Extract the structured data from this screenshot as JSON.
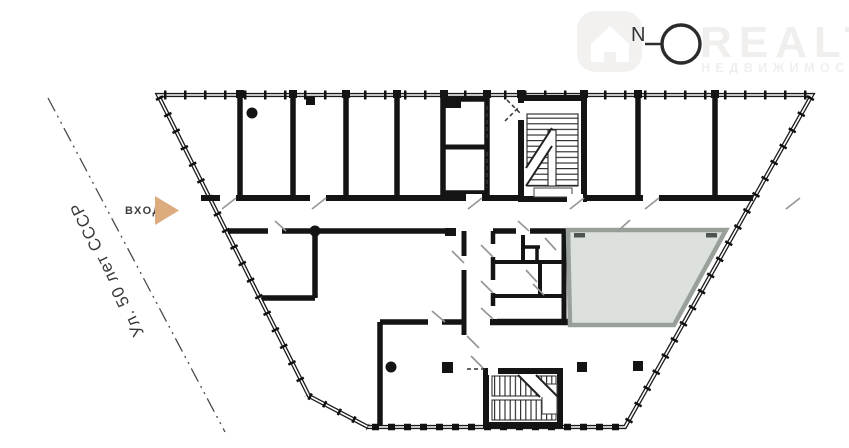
{
  "street": {
    "label": "Ул. 50 лет СССР"
  },
  "entrance": {
    "label": "ВХОД"
  },
  "compass": {
    "label": "N"
  },
  "watermark": {
    "brand": "REALT",
    "tagline": "НЕДВИЖИМОСТЬ"
  },
  "colors": {
    "wall": "#141414",
    "door_tick": "#979797",
    "street_line": "#4a4a4a",
    "entrance_arrow": "#dcab7e",
    "highlight_fill": "#dde1dc",
    "highlight_border": "#99a099",
    "watermark_gray": "#f0efee"
  },
  "plan": {
    "highlighted_room": {
      "status": "selected-unit"
    }
  }
}
